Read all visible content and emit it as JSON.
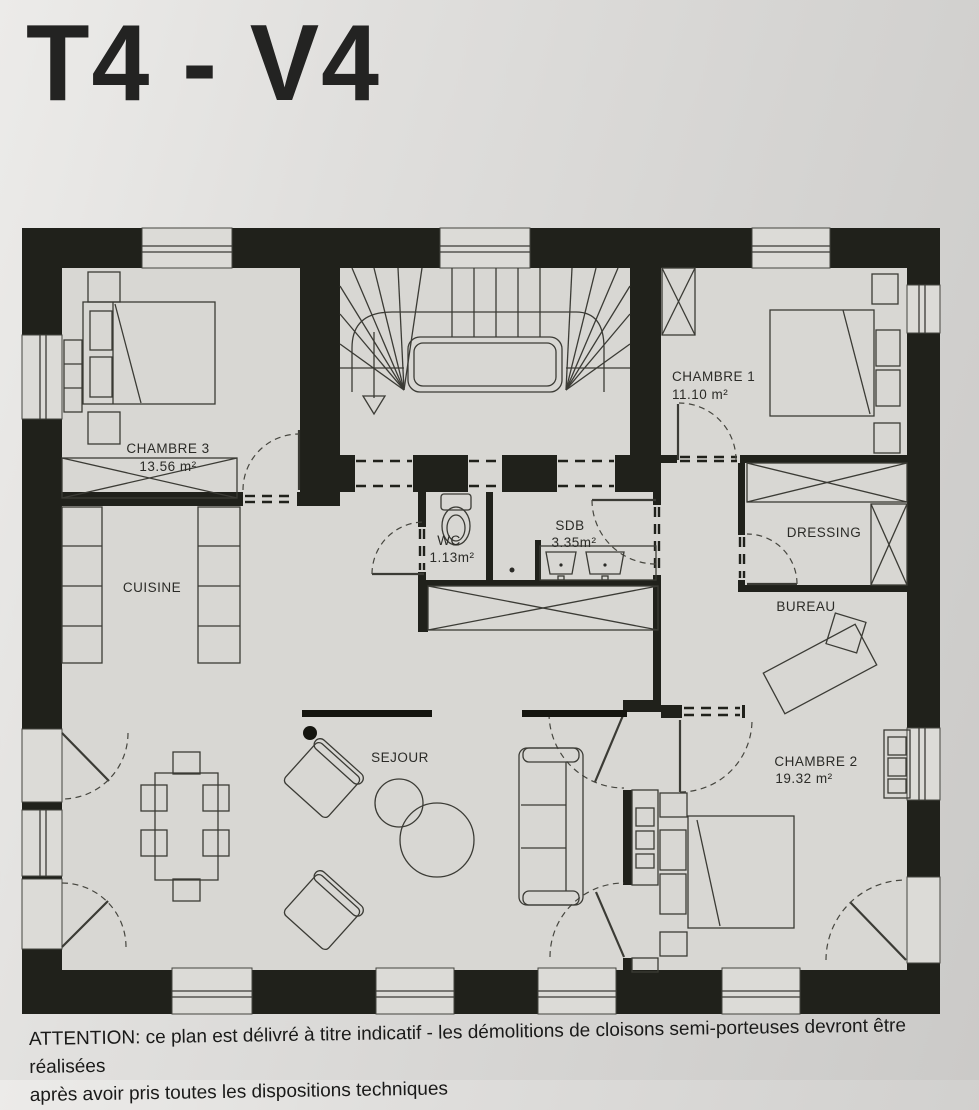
{
  "title": "T4 - V4",
  "plan": {
    "rooms": {
      "chambre3": {
        "name": "CHAMBRE 3",
        "area": "13.56 m²"
      },
      "chambre1": {
        "name": "CHAMBRE 1",
        "area": "11.10 m²"
      },
      "chambre2": {
        "name": "CHAMBRE 2",
        "area": "19.32 m²"
      },
      "cuisine": {
        "name": "CUISINE"
      },
      "sejour": {
        "name": "SEJOUR"
      },
      "wc": {
        "name": "WC",
        "area": "1.13m²"
      },
      "sdb": {
        "name": "SDB",
        "area": "3.35m²"
      },
      "dressing": {
        "name": "DRESSING"
      },
      "bureau": {
        "name": "BUREAU"
      }
    },
    "colors": {
      "wall": "#20211b",
      "floor": "#d8d7d3",
      "paper": "#d9d8d6",
      "line": "#3b3b35"
    }
  },
  "footer": {
    "line1": "ATTENTION: ce plan est délivré à titre indicatif  - les démolitions de cloisons semi-porteuses devront être réalisées",
    "line2": "après avoir pris toutes les dispositions techniques"
  }
}
